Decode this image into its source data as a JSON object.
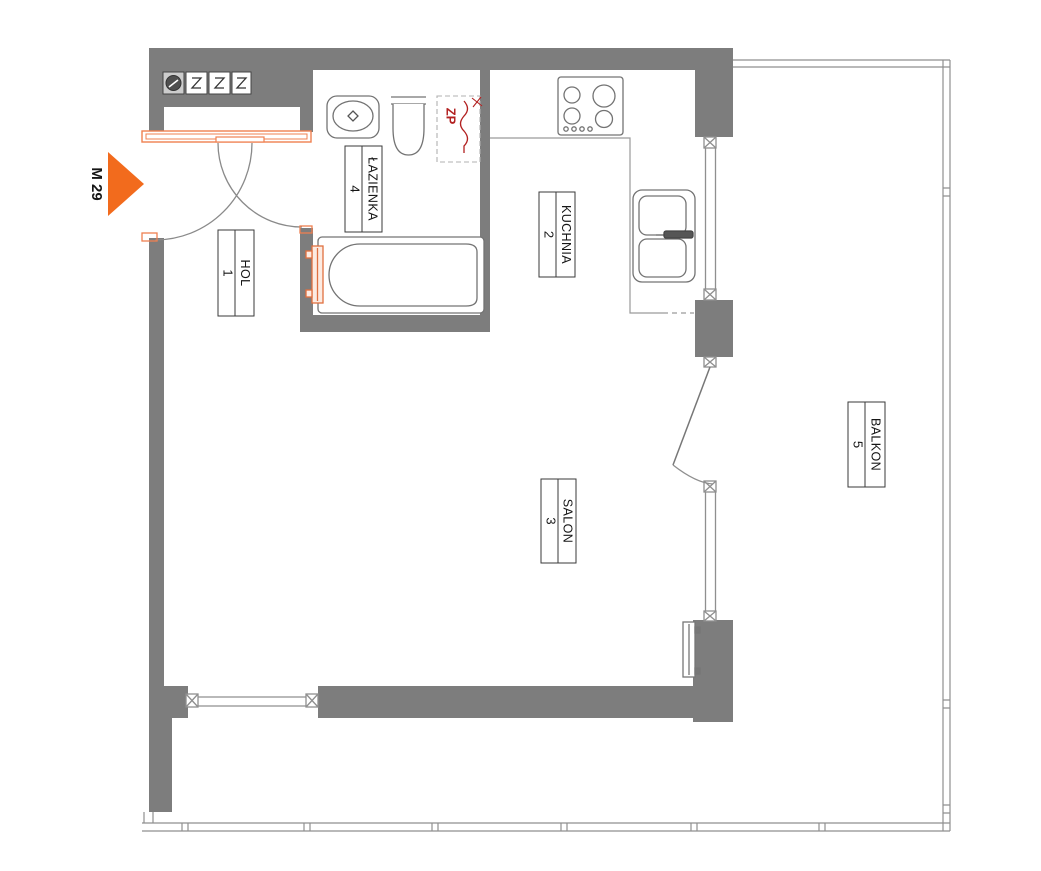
{
  "plan": {
    "unit_label": "M 29",
    "rooms": [
      {
        "key": "hol",
        "name": "HOL",
        "number": "1"
      },
      {
        "key": "kuchnia",
        "name": "KUCHNIA",
        "number": "2"
      },
      {
        "key": "salon",
        "name": "SALON",
        "number": "3"
      },
      {
        "key": "lazienka",
        "name": "ŁAZIENKA",
        "number": "4"
      },
      {
        "key": "balkon",
        "name": "BALKON",
        "number": "5"
      }
    ],
    "annotations": {
      "riser": "ZP"
    },
    "wall_boxes": [
      "electric-meter",
      "vent-shaft",
      "vent-shaft",
      "vent-shaft"
    ],
    "colors": {
      "wall_gray": "#7d7d7d",
      "line_gray": "#8f8f8f",
      "fixture_gray": "#737373",
      "accent_orange": "#f26b1d",
      "frame_orange": "#ef8050",
      "riser_red": "#b22020"
    }
  }
}
